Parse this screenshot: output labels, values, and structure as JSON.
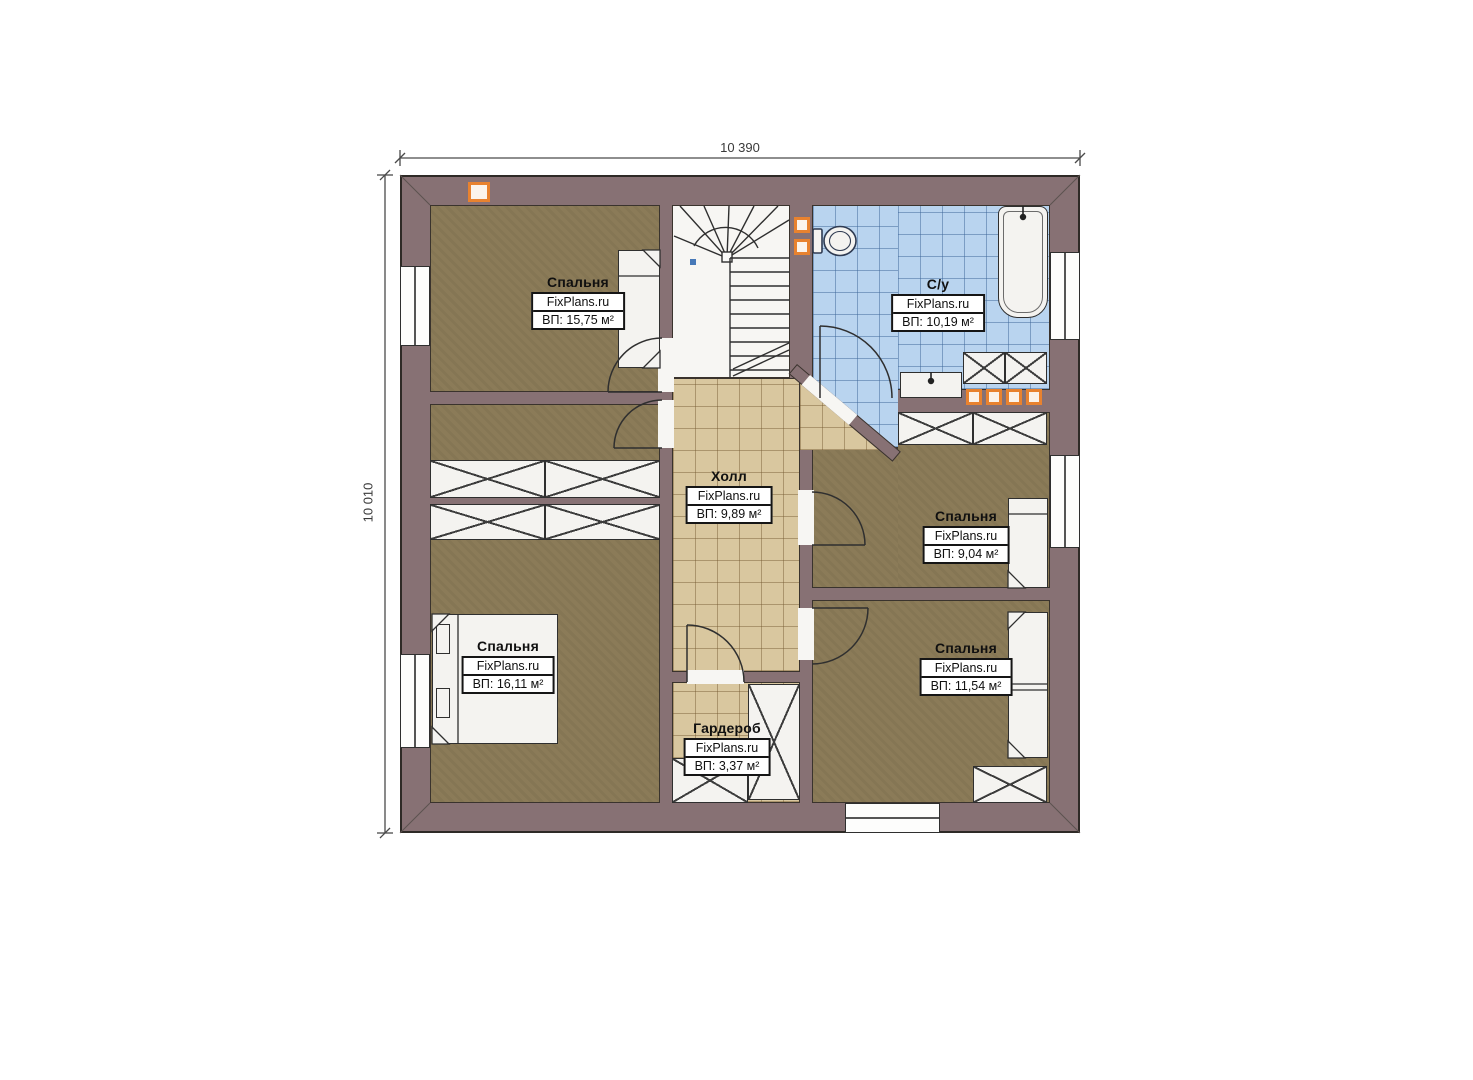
{
  "branding": "FixPlans.ru",
  "dimensions": {
    "top_label": "10 390",
    "left_label": "10 010"
  },
  "rooms": [
    {
      "id": "bedroom-top-left",
      "name": "Спальня",
      "area": "ВП: 15,75 м²"
    },
    {
      "id": "bathroom",
      "name": "С/у",
      "area": "ВП: 10,19 м²"
    },
    {
      "id": "hall",
      "name": "Холл",
      "area": "ВП: 9,89 м²"
    },
    {
      "id": "bedroom-mid-right",
      "name": "Спальня",
      "area": "ВП: 9,04 м²"
    },
    {
      "id": "bedroom-bottom-left",
      "name": "Спальня",
      "area": "ВП: 16,11 м²"
    },
    {
      "id": "bedroom-bottom-right",
      "name": "Спальня",
      "area": "ВП: 11,54 м²"
    },
    {
      "id": "wardrobe",
      "name": "Гардероб",
      "area": "ВП: 3,37 м²"
    }
  ],
  "colors": {
    "wall": "#877174",
    "bedroom_floor": "#8b7b58",
    "hall_tile": "#d9c79f",
    "bath_tile": "#b9d4ef",
    "accent_orange": "#e8822f",
    "fixture_white": "#f4f3f0"
  }
}
